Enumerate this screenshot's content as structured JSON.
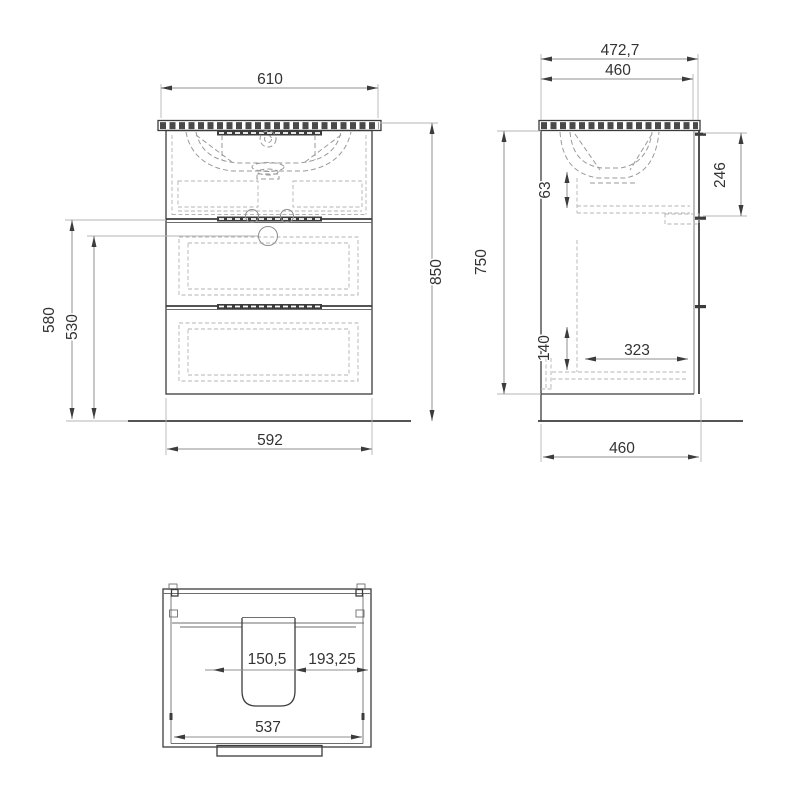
{
  "drawing": {
    "type": "technical-drawing",
    "subject": "bathroom vanity cabinet with washbasin, three orthographic views",
    "colors": {
      "background": "#ffffff",
      "line": "#3c3c3c",
      "dimension": "#8f8f8f",
      "text": "#333333"
    },
    "views": {
      "front": {
        "dims": {
          "width_top": "610",
          "height_overall": "850",
          "height_drawer_top": "580",
          "height_hole": "530",
          "width_bottom": "592"
        }
      },
      "side": {
        "dims": {
          "depth_countertop": "472,7",
          "depth_cabinet_top": "460",
          "height_body": "750",
          "height_top_drawer": "246",
          "clearance_sink": "63",
          "height_bottom": "140",
          "depth_drawer_inner": "323",
          "depth_cabinet_bottom": "460"
        }
      },
      "top": {
        "dims": {
          "cutout_width": "150,5",
          "offset_right": "193,25",
          "inner_width": "537"
        }
      }
    }
  }
}
